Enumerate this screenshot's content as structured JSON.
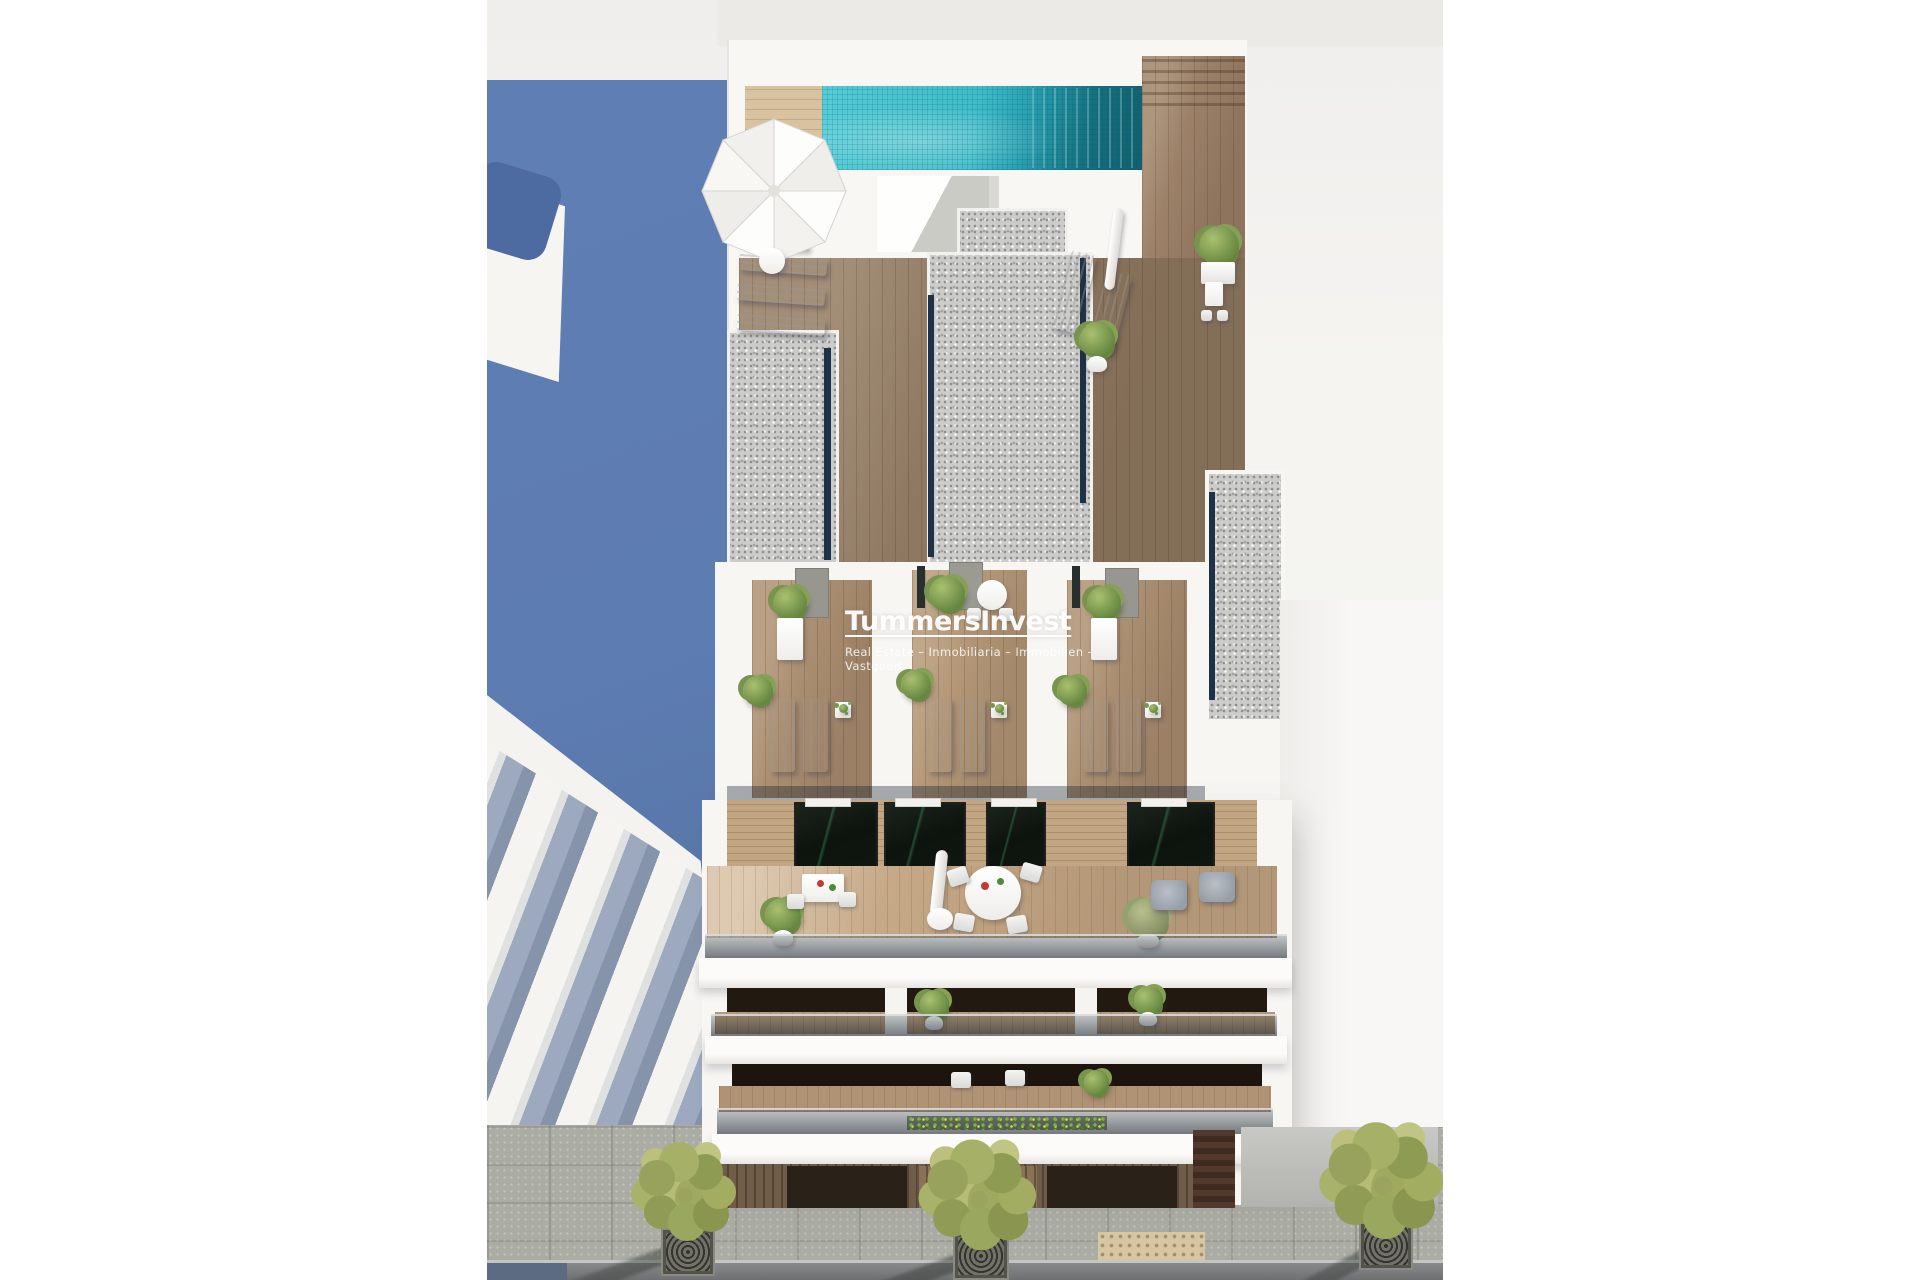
{
  "watermark": {
    "title": "TummersInvest",
    "subtitle": "Real Estate – Inmobiliaria – Immobilien – Vastgoed"
  },
  "palette": {
    "page_background": "#ffffff",
    "scene_background": "#f3f2ef",
    "cast_shadow_blue": "#5d7cb2",
    "pool_turquoise": "#3fbcc9",
    "pool_deep_teal": "#15707f",
    "deck_wood_light": "#d9c2a0",
    "deck_wood_medium": "#a98d70",
    "deck_wood_dark": "#8f7962",
    "gravel_gray": "#cccccb",
    "glass_balustrade_navy": "#1d3148",
    "window_glass_dark": "#0e150e",
    "foliage_green": "#9aa45f",
    "paving_gray": "#abaca4",
    "tactile_paving_tan": "#d8c6a2",
    "road_gray": "#87898a"
  }
}
